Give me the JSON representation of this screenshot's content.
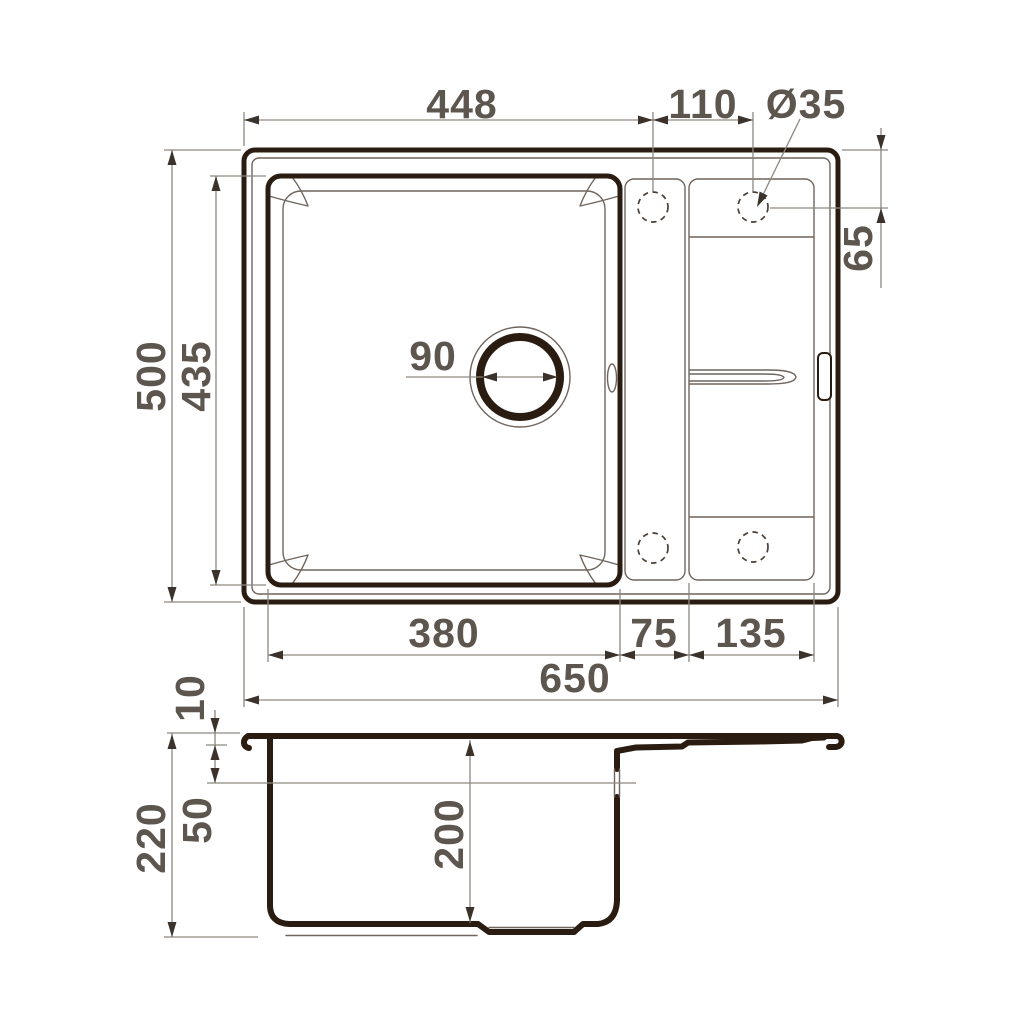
{
  "drawing": {
    "top_view": {
      "dims": {
        "width_to_first_hole": "448",
        "hole_spacing": "110",
        "faucet_hole_diameter": "Ø35",
        "overall_depth": "500",
        "bowl_inner_length": "435",
        "faucet_hole_offset": "65",
        "drain_diameter": "90",
        "bowl_width": "380",
        "divider_width": "75",
        "drainboard_width": "135",
        "overall_width": "650"
      }
    },
    "side_view": {
      "dims": {
        "rim_thickness": "10",
        "overall_height": "220",
        "overflow_offset": "50",
        "bowl_depth": "200"
      }
    },
    "colors": {
      "outline": "#2a1c10",
      "thin_line": "#6f655d",
      "dimension_line": "#8d8780",
      "dimension_text": "#5d564f",
      "arrow": "#3a322b",
      "background": "#ffffff"
    }
  }
}
